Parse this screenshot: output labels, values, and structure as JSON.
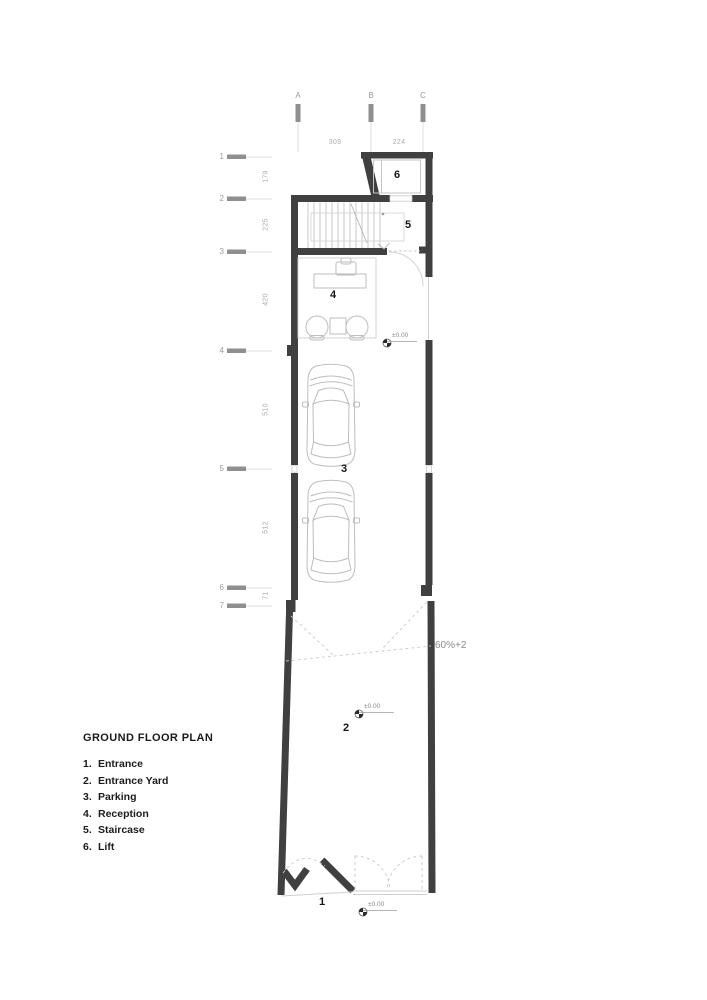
{
  "title": "GROUND FLOOR PLAN",
  "legend": {
    "items": [
      {
        "num": "1.",
        "label": "Entrance"
      },
      {
        "num": "2.",
        "label": "Entrance Yard"
      },
      {
        "num": "3.",
        "label": "Parking"
      },
      {
        "num": "4.",
        "label": "Reception"
      },
      {
        "num": "5.",
        "label": "Staircase"
      },
      {
        "num": "6.",
        "label": "Lift"
      }
    ]
  },
  "grid": {
    "columns": [
      {
        "label": "A"
      },
      {
        "label": "B"
      },
      {
        "label": "C"
      }
    ],
    "rows": [
      {
        "label": "1"
      },
      {
        "label": "2"
      },
      {
        "label": "3"
      },
      {
        "label": "4"
      },
      {
        "label": "5"
      },
      {
        "label": "6"
      },
      {
        "label": "7"
      }
    ],
    "top_dimensions": [
      {
        "value": "309"
      },
      {
        "value": "224"
      }
    ],
    "left_dimensions": [
      {
        "value": "179"
      },
      {
        "value": "225"
      },
      {
        "value": "420"
      },
      {
        "value": "510"
      },
      {
        "value": "512"
      },
      {
        "value": "71"
      }
    ]
  },
  "plan": {
    "room_numbers": {
      "entrance": "1",
      "entrance_yard": "2",
      "parking": "3",
      "reception": "4",
      "staircase": "5",
      "lift": "6"
    },
    "levels": {
      "reception": "±0.00",
      "yard": "±0.00",
      "entrance": "±0.00"
    },
    "ramp_slope": "60%+2"
  },
  "colors": {
    "wall": "#404040",
    "thin_outline": "#c6c6c6",
    "furniture": "#bdbdbd",
    "dashed": "#c9c9c9",
    "grid_tick": "#8f8f8f",
    "dim_text": "#ababab",
    "label_text": "#161616"
  }
}
